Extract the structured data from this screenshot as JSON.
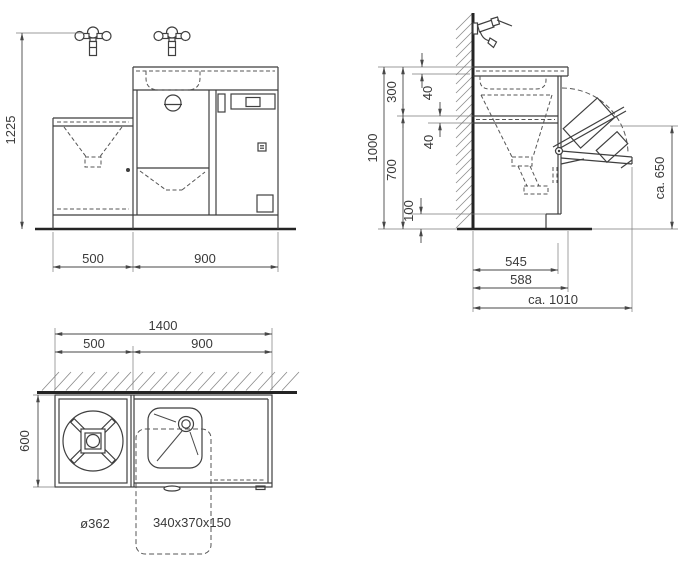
{
  "drawing": {
    "type": "technical-drawing",
    "subject": "Utility sink and washing machine cabinet unit",
    "views": {
      "front": {
        "label": "front-elevation",
        "dims": {
          "height": "1225",
          "left_width": "500",
          "right_width": "900"
        }
      },
      "side": {
        "label": "side-section",
        "dims": {
          "total_height": "1000",
          "upper_section": "300",
          "worktop_offset": "40",
          "lower_section": "700",
          "mid_offset": "40",
          "plinth_height": "100",
          "body_depth": "545",
          "worktop_depth": "588",
          "open_depth": "ca. 1010",
          "flap_height": "ca. 650"
        }
      },
      "plan": {
        "label": "top-view",
        "dims": {
          "total_width": "1400",
          "left_width": "500",
          "right_width": "900",
          "depth": "600",
          "round_bowl": "ø362",
          "basin": "340x370x150"
        }
      }
    }
  }
}
